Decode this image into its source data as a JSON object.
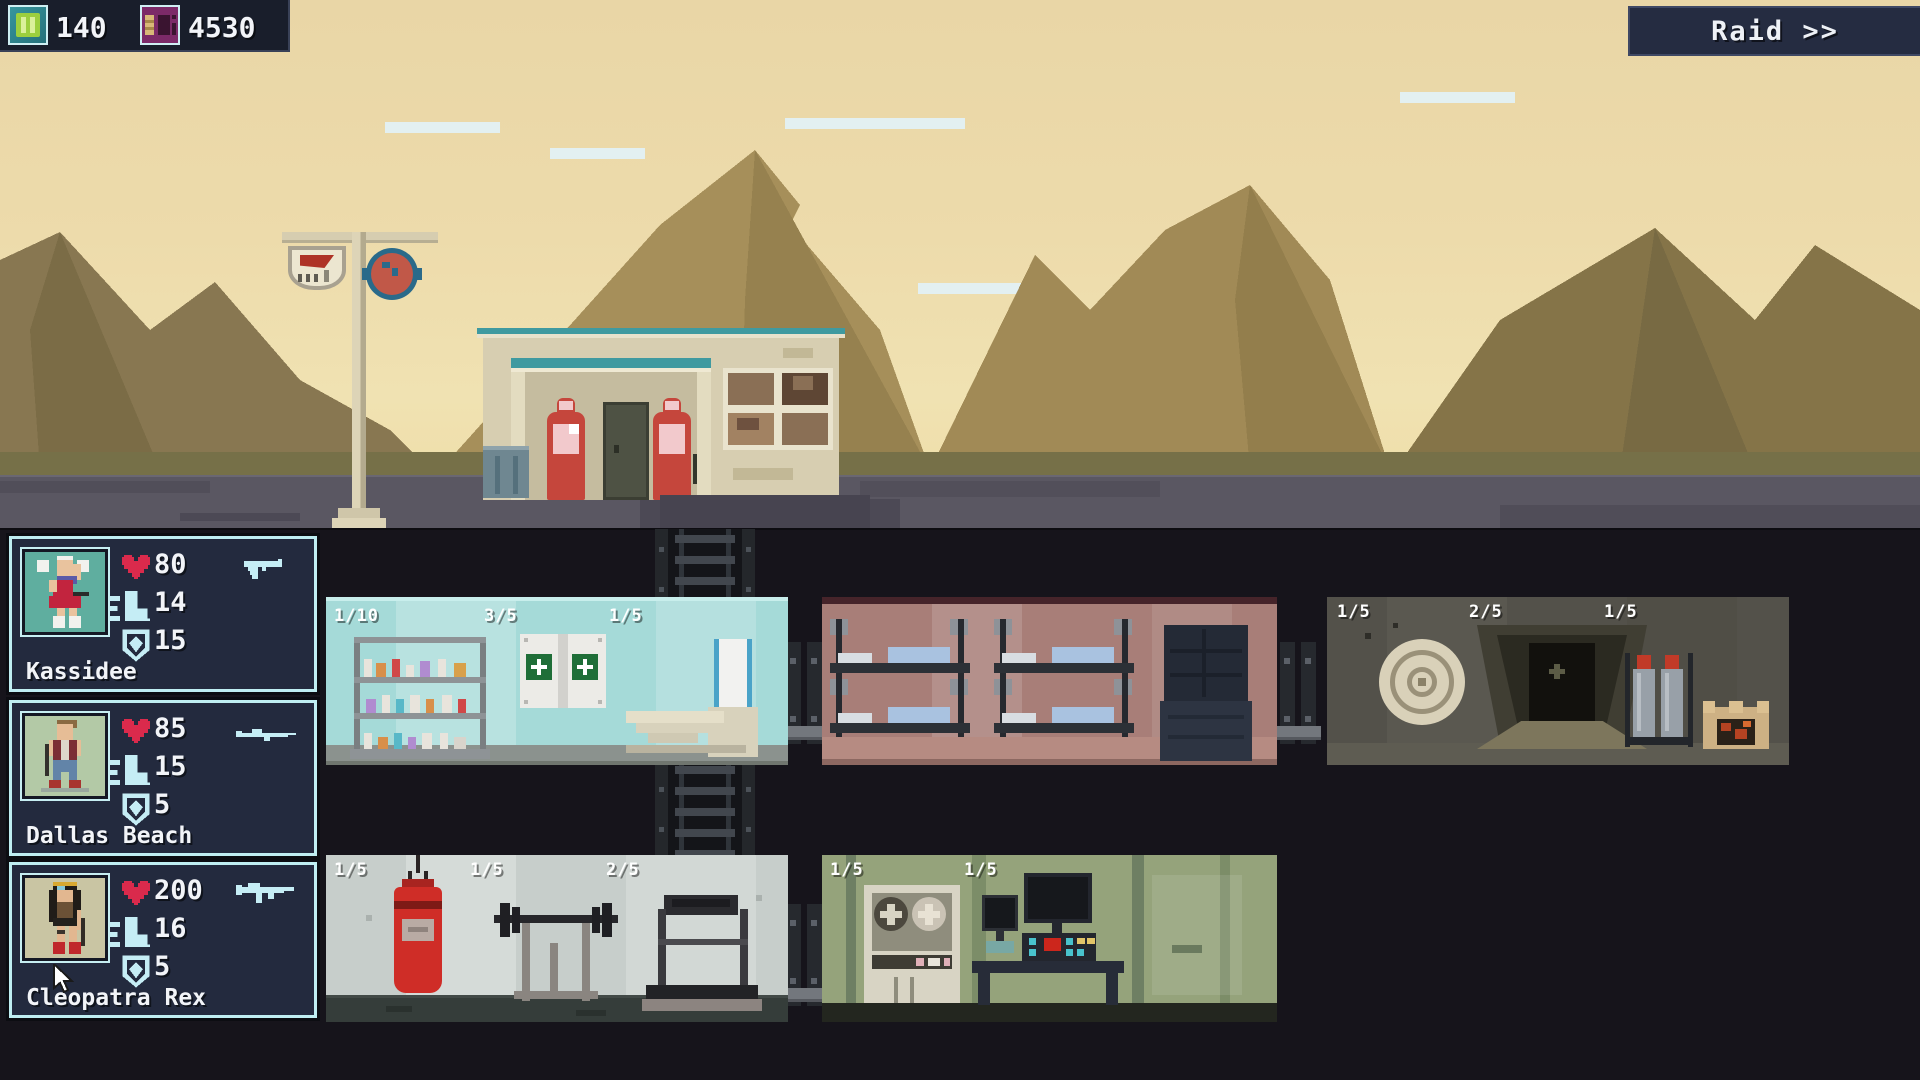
{
  "hud": {
    "resources": [
      {
        "name": "energy",
        "value": "140"
      },
      {
        "name": "scrap",
        "value": "4530"
      }
    ],
    "raid_label": "Raid >>"
  },
  "party": [
    {
      "name": "Kassidee",
      "health": "80",
      "speed": "14",
      "defense": "15",
      "weapon": "pistol"
    },
    {
      "name": "Dallas Beach",
      "health": "85",
      "speed": "15",
      "defense": "5",
      "weapon": "rifle"
    },
    {
      "name": "Cleopatra Rex",
      "health": "200",
      "speed": "16",
      "defense": "5",
      "weapon": "smg"
    }
  ],
  "rooms": {
    "medical": {
      "labels": [
        "1/10",
        "3/5",
        "1/5"
      ]
    },
    "bunks": {
      "labels": []
    },
    "tunnel": {
      "labels": [
        "1/5",
        "2/5",
        "1/5"
      ]
    },
    "gym": {
      "labels": [
        "1/5",
        "1/5",
        "2/5"
      ]
    },
    "computer": {
      "labels": [
        "1/5",
        "1/5"
      ]
    }
  },
  "colors": {
    "accent_cyan": "#c5edf5",
    "heart_red": "#da2a4c",
    "panel_navy": "#232a3e",
    "raid_navy": "#252c41"
  }
}
